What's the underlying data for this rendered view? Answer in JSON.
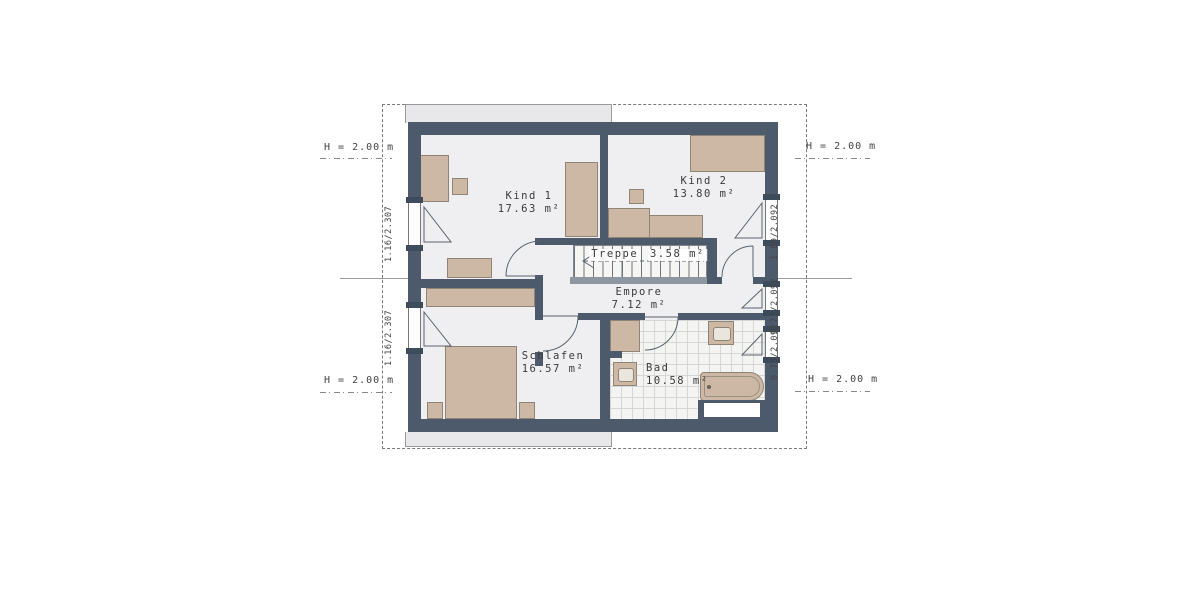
{
  "rooms": [
    {
      "name": "Kind 1",
      "area": "17.63 m²"
    },
    {
      "name": "Kind 2",
      "area": "13.80 m²"
    },
    {
      "name": "Treppe",
      "area": "3.58 m²"
    },
    {
      "name": "Empore",
      "area": "7.12 m²"
    },
    {
      "name": "Schlafen",
      "area": "16.57 m²"
    },
    {
      "name": "Bad",
      "area": "10.58 m²"
    }
  ],
  "height_markers": {
    "top_left": "H = 2.00 m",
    "top_right": "H = 2.00 m",
    "bottom_left": "H = 2.00 m",
    "bottom_right": "H = 2.00 m"
  },
  "window_dimensions": {
    "left_upper": "1.16/2.307",
    "left_lower": "1.16/2.307",
    "right_upper": "1.09/2.092",
    "right_middle": "0.73/2.092",
    "right_lower": "0.73/2.092"
  },
  "colors": {
    "wall": "#4c5a6c",
    "floor": "#efeff1",
    "furniture": "#ccb8a4",
    "lower_floor_outline": "#e8e8ea",
    "railing": "#8d97a2"
  }
}
